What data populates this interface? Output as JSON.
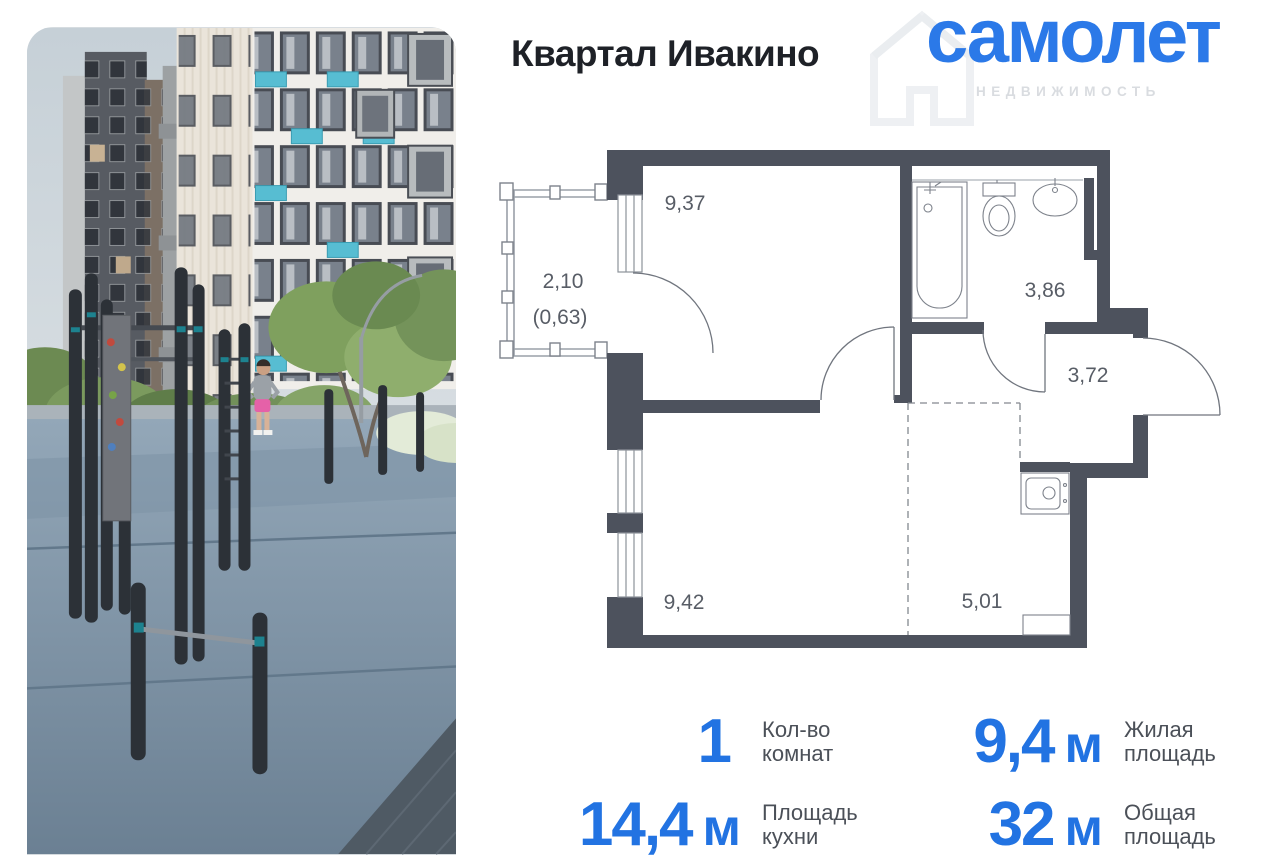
{
  "header": {
    "title": "Квартал Ивакино"
  },
  "logo": {
    "brand": "самолет",
    "subtitle": "НЕДВИЖИМОСТЬ"
  },
  "floor_plan": {
    "labels": {
      "room_area": "9,37",
      "balcony_width": "2,10",
      "balcony_area": "(0,63)",
      "bathroom_area": "3,86",
      "hallway_area": "3,72",
      "kitchen_living_area": "9,42",
      "kitchen_niche_area": "5,01"
    }
  },
  "stats": {
    "rooms": {
      "value": "1",
      "label_line1": "Кол-во",
      "label_line2": "комнат"
    },
    "living": {
      "value": "9,4",
      "unit": "м",
      "label_line1": "Жилая",
      "label_line2": "площадь"
    },
    "kitchen": {
      "value": "14,4",
      "unit": "м",
      "label_line1": "Площадь",
      "label_line2": "кухни"
    },
    "total": {
      "value": "32",
      "unit": "м",
      "label_line1": "Общая",
      "label_line2": "площадь"
    }
  },
  "colors": {
    "accent_blue": "#2273e2",
    "plan_wall": "#4d525d",
    "balcony_teal": "#57bdd2"
  }
}
